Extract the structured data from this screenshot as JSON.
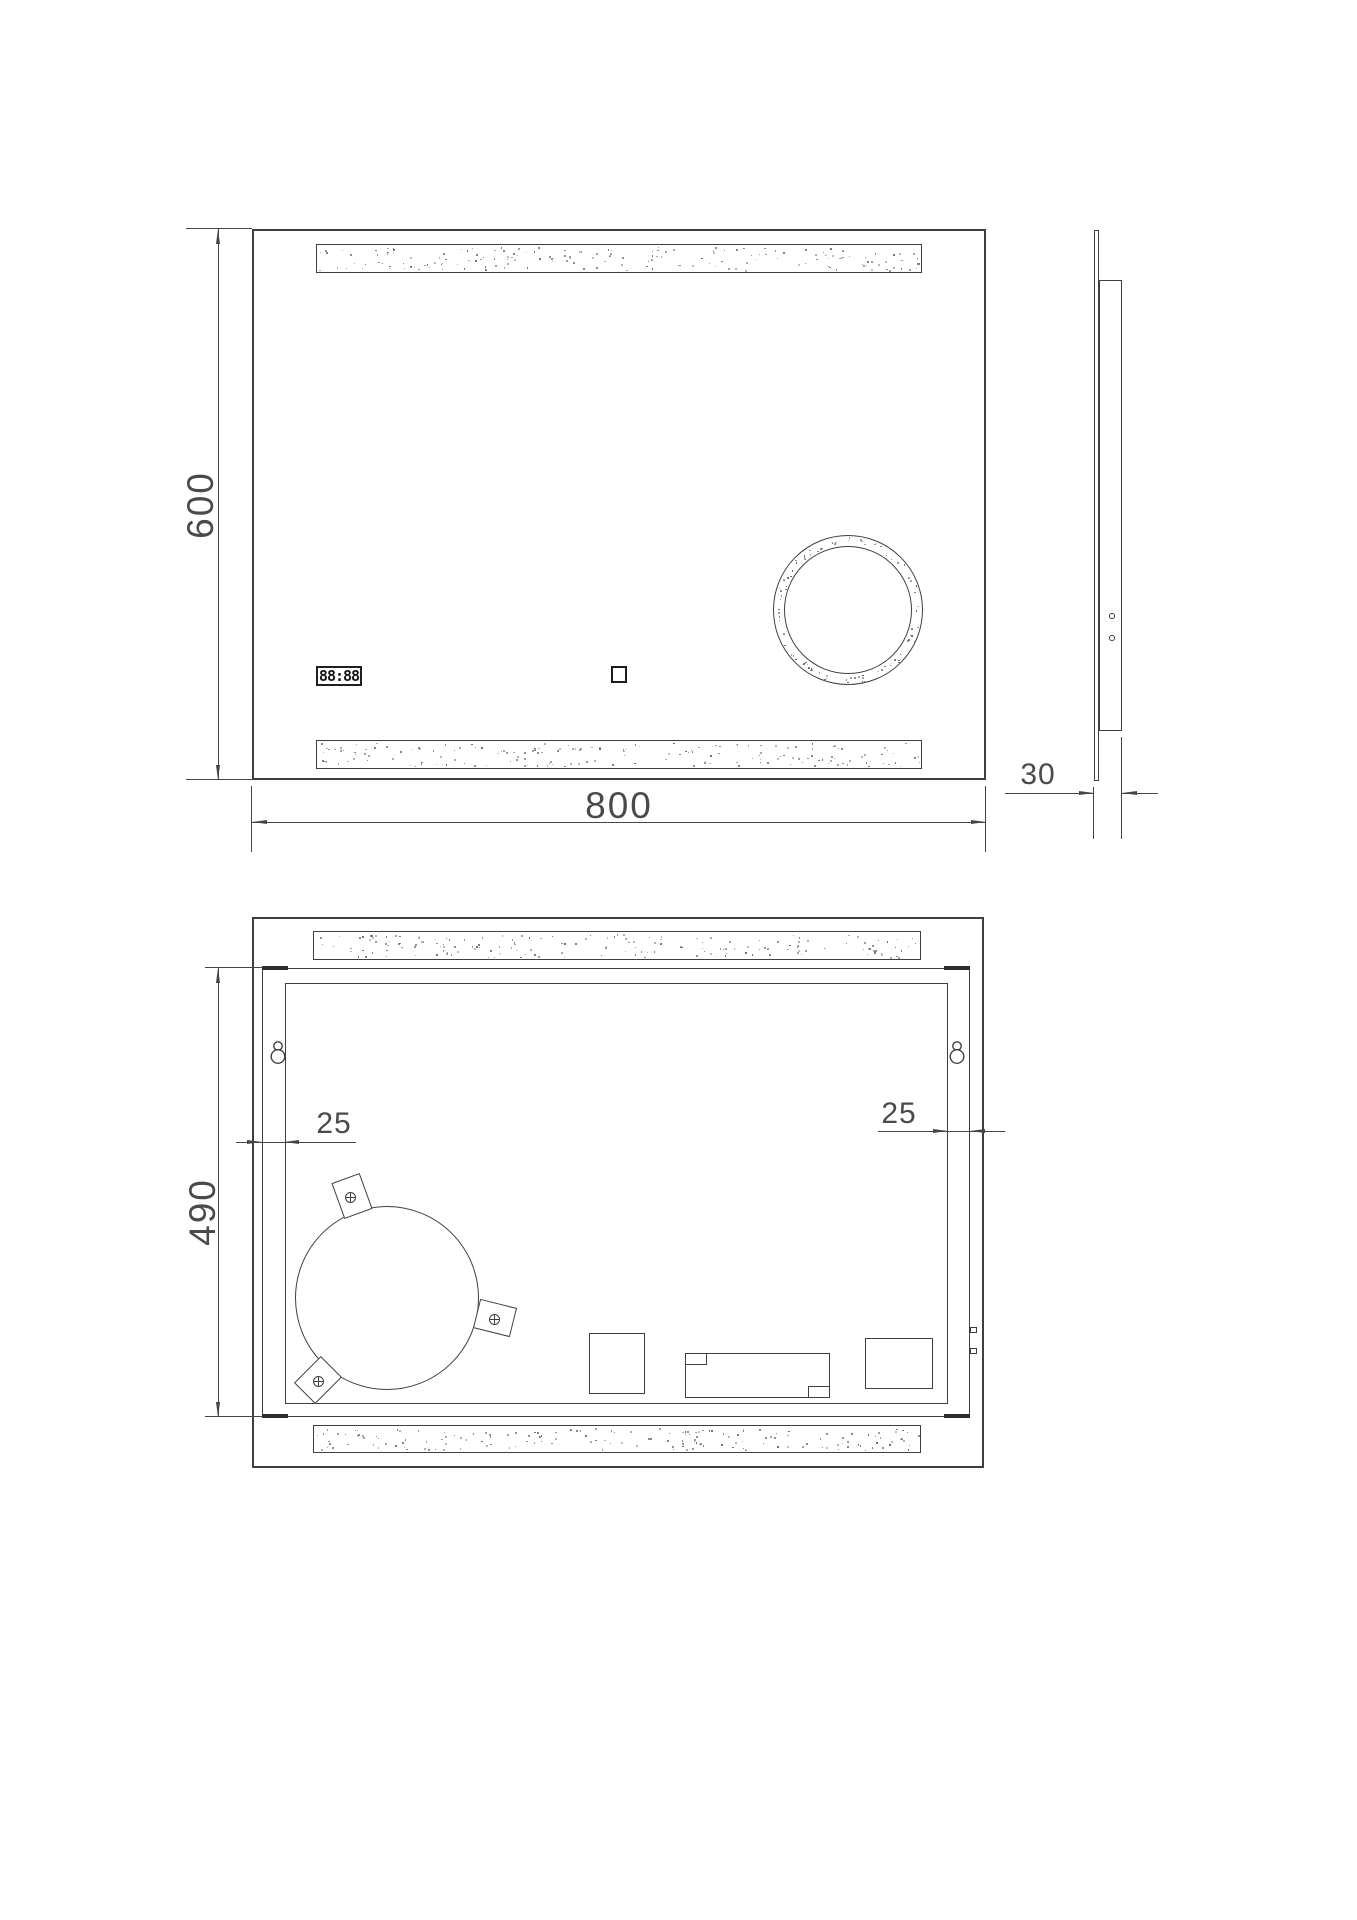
{
  "drawing": {
    "front_view": {
      "height_dim": "600",
      "width_dim": "800",
      "clock_display": "88:88"
    },
    "side_view": {
      "depth_dim": "30"
    },
    "rear_view": {
      "height_dim": "490",
      "left_frame_dim": "25",
      "right_frame_dim": "25"
    },
    "colors": {
      "line": "#454545",
      "text": "#4a4a4a",
      "stipple": "#4d4d4d",
      "background": "#ffffff"
    }
  }
}
